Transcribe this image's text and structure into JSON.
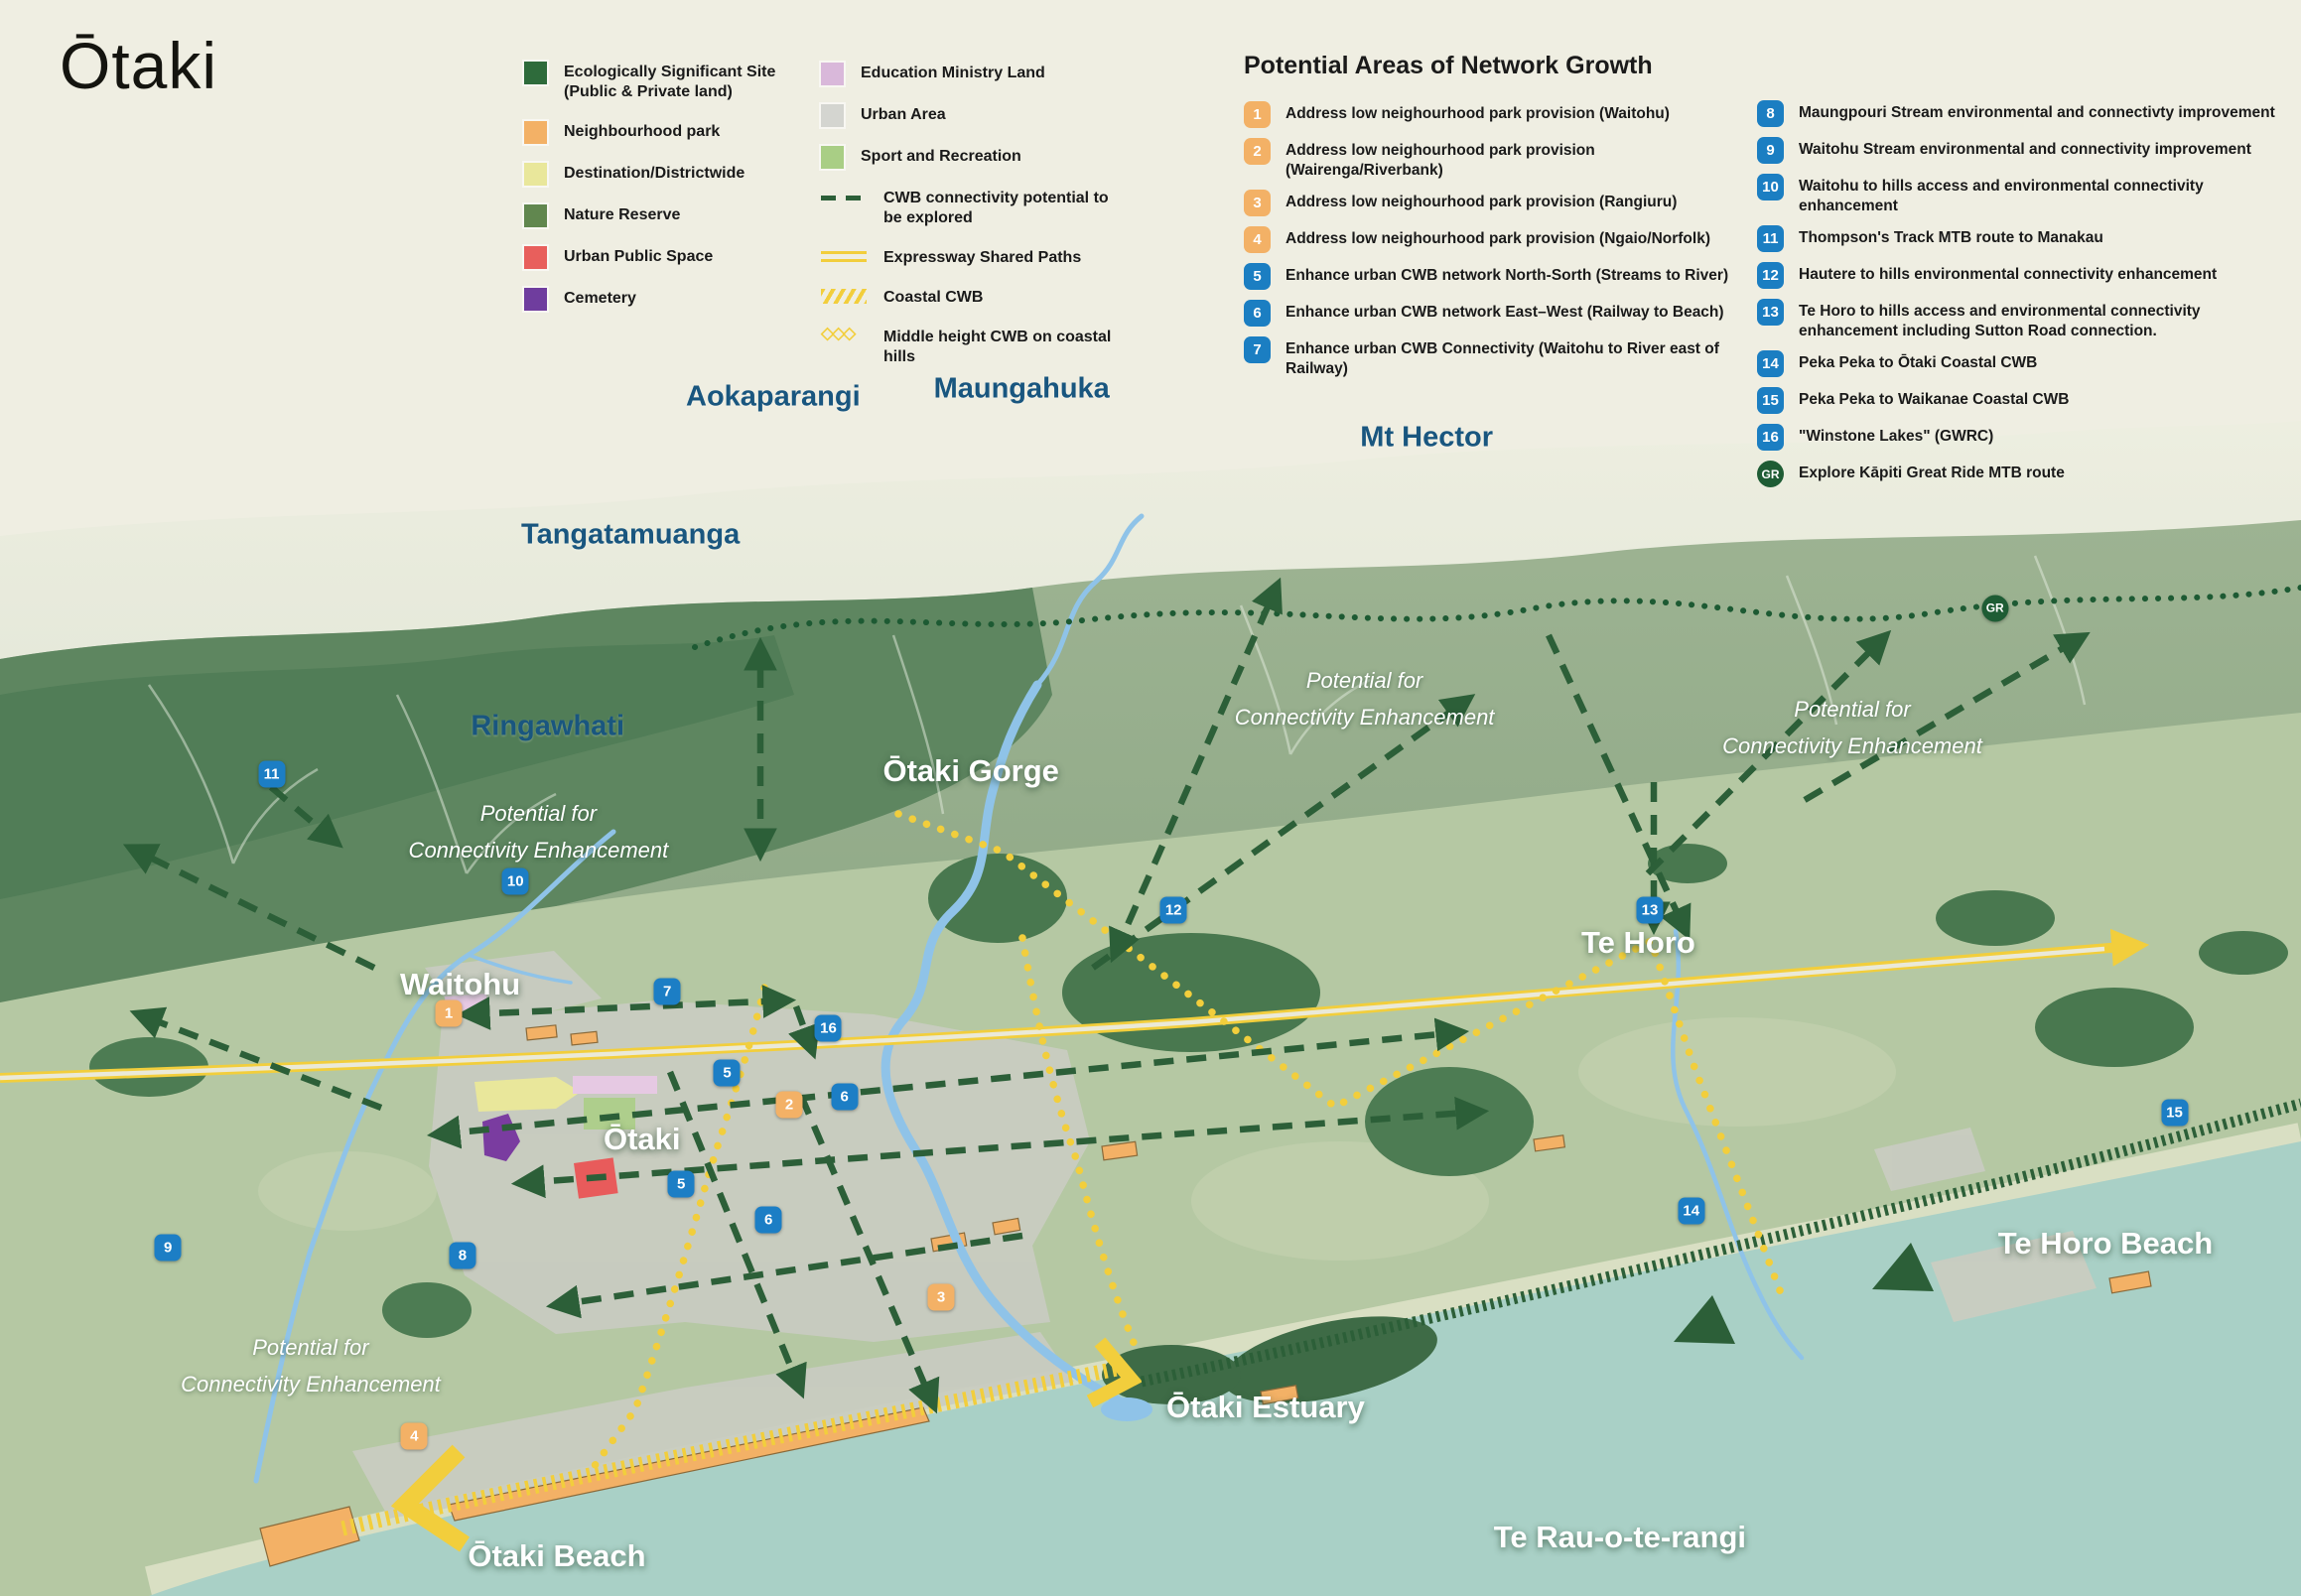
{
  "title": "Ōtaki",
  "legend": {
    "col1": [
      {
        "label": "Ecologically Significant Site (Public & Private land)",
        "kind": "swatch",
        "color": "#2E6B3B"
      },
      {
        "label": "Neighbourhood park",
        "kind": "swatch",
        "color": "#F3B166"
      },
      {
        "label": "Destination/Districtwide",
        "kind": "swatch",
        "color": "#E9E79B"
      },
      {
        "label": "Nature Reserve",
        "kind": "swatch",
        "color": "#61874F"
      },
      {
        "label": "Urban Public Space",
        "kind": "swatch",
        "color": "#E85F5C"
      },
      {
        "label": "Cemetery",
        "kind": "swatch",
        "color": "#6F3D9E"
      }
    ],
    "col2": [
      {
        "label": "Education Ministry Land",
        "kind": "swatch",
        "color": "#D9B8DA"
      },
      {
        "label": "Urban Area",
        "kind": "swatch",
        "color": "#D4D5D0"
      },
      {
        "label": "Sport and Recreation",
        "kind": "swatch",
        "color": "#A9CE85"
      },
      {
        "label": "CWB connectivity potential to be explored",
        "kind": "dashed",
        "color": "#2C5F38"
      },
      {
        "label": "Expressway Shared Paths",
        "kind": "double",
        "color": "#F2CE3C"
      },
      {
        "label": "Coastal CWB",
        "kind": "hatch",
        "color": "#F2CE3C"
      },
      {
        "label": "Middle height CWB on coastal hills",
        "kind": "diamonds",
        "color": "#F2CE3C"
      }
    ]
  },
  "growth": {
    "heading": "Potential Areas of Network Growth",
    "badge_colors": {
      "orange": "#F3B166",
      "blue": "#1B7EC2",
      "green": "#1E5C34"
    },
    "col1": [
      {
        "n": "1",
        "c": "orange",
        "text": "Address low neighourhood park provision (Waitohu)"
      },
      {
        "n": "2",
        "c": "orange",
        "text": "Address low neighourhood park provision (Wairenga/Riverbank)"
      },
      {
        "n": "3",
        "c": "orange",
        "text": "Address low neighourhood park provision (Rangiuru)"
      },
      {
        "n": "4",
        "c": "orange",
        "text": "Address low neighourhood park provision (Ngaio/Norfolk)"
      },
      {
        "n": "5",
        "c": "blue",
        "text": "Enhance urban CWB network North-Sorth (Streams to River)"
      },
      {
        "n": "6",
        "c": "blue",
        "text": "Enhance urban CWB network East–West (Railway to Beach)"
      },
      {
        "n": "7",
        "c": "blue",
        "text": "Enhance urban CWB Connectivity (Waitohu to River east of Railway)"
      }
    ],
    "col2": [
      {
        "n": "8",
        "c": "blue",
        "text": "Maungpouri Stream environmental and connectivty improvement"
      },
      {
        "n": "9",
        "c": "blue",
        "text": "Waitohu Stream environmental and connectivity improvement"
      },
      {
        "n": "10",
        "c": "blue",
        "text": "Waitohu to hills access and environmental connectivity enhancement"
      },
      {
        "n": "11",
        "c": "blue",
        "text": "Thompson's Track MTB route to Manakau"
      },
      {
        "n": "12",
        "c": "blue",
        "text": "Hautere to hills environmental connectivity enhancement"
      },
      {
        "n": "13",
        "c": "blue",
        "text": "Te Horo to hills access and environmental connectivity enhancement including Sutton Road connection."
      },
      {
        "n": "14",
        "c": "blue",
        "text": "Peka Peka to Ōtaki Coastal CWB"
      },
      {
        "n": "15",
        "c": "blue",
        "text": "Peka Peka to Waikanae Coastal CWB"
      },
      {
        "n": "16",
        "c": "blue",
        "text": "\"Winstone Lakes\" (GWRC)"
      },
      {
        "n": "GR",
        "c": "green",
        "text": "Explore Kāpiti Great Ride MTB route"
      }
    ]
  },
  "map": {
    "colors": {
      "background": "#EFEEE2",
      "sea": "#A9D0C6",
      "plain": "#B5C8A3",
      "forest_dark": "#5E8660",
      "eco_patch": "#3E7047",
      "urban": "#C9CCC1",
      "river": "#8FC3E8",
      "route_yellow": "#F2CE3C",
      "route_green": "#2C5F38",
      "label_blue": "#19567F"
    },
    "places": [
      {
        "text": "Aokaparangi",
        "kind": "mountain",
        "x": 33.6,
        "y": 24.9
      },
      {
        "text": "Maungahuka",
        "kind": "mountain",
        "x": 44.4,
        "y": 24.4
      },
      {
        "text": "Mt Hector",
        "kind": "mountain",
        "x": 62.0,
        "y": 27.4
      },
      {
        "text": "Tangatamuanga",
        "kind": "mountain",
        "x": 27.4,
        "y": 33.5
      },
      {
        "text": "Ringawhati",
        "kind": "mountain",
        "x": 23.8,
        "y": 45.5
      },
      {
        "text": "Ōtaki Gorge",
        "kind": "town",
        "x": 42.2,
        "y": 48.3
      },
      {
        "text": "Waitohu",
        "kind": "town",
        "x": 20.0,
        "y": 61.7
      },
      {
        "text": "Ōtaki",
        "kind": "town",
        "x": 27.9,
        "y": 71.4
      },
      {
        "text": "Te Horo",
        "kind": "town",
        "x": 71.2,
        "y": 59.1
      },
      {
        "text": "Te Horo Beach",
        "kind": "town",
        "x": 91.5,
        "y": 77.9
      },
      {
        "text": "Ōtaki Estuary",
        "kind": "town",
        "x": 55.0,
        "y": 88.2
      },
      {
        "text": "Ōtaki Beach",
        "kind": "town",
        "x": 24.2,
        "y": 97.5
      },
      {
        "text": "Te Rau-o-te-rangi",
        "kind": "town",
        "x": 70.4,
        "y": 96.3
      }
    ],
    "annotations": [
      {
        "line1": "Potential for",
        "line2": "Connectivity Enhancement",
        "x": 23.4,
        "y": 52.1
      },
      {
        "line1": "Potential for",
        "line2": "Connectivity Enhancement",
        "x": 59.3,
        "y": 43.8
      },
      {
        "line1": "Potential for",
        "line2": "Connectivity Enhancement",
        "x": 80.5,
        "y": 45.6
      },
      {
        "line1": "Potential for",
        "line2": "Connectivity Enhancement",
        "x": 13.5,
        "y": 85.6
      }
    ],
    "markers": [
      {
        "n": "1",
        "c": "orange",
        "x": 19.5,
        "y": 63.5
      },
      {
        "n": "2",
        "c": "orange",
        "x": 34.3,
        "y": 69.2
      },
      {
        "n": "3",
        "c": "orange",
        "x": 40.9,
        "y": 81.3
      },
      {
        "n": "4",
        "c": "orange",
        "x": 18.0,
        "y": 90.0
      },
      {
        "n": "5",
        "c": "blue",
        "x": 31.6,
        "y": 67.2
      },
      {
        "n": "5",
        "c": "blue",
        "x": 29.6,
        "y": 74.2
      },
      {
        "n": "6",
        "c": "blue",
        "x": 36.7,
        "y": 68.7
      },
      {
        "n": "6",
        "c": "blue",
        "x": 33.4,
        "y": 76.4
      },
      {
        "n": "7",
        "c": "blue",
        "x": 29.0,
        "y": 62.1
      },
      {
        "n": "8",
        "c": "blue",
        "x": 20.1,
        "y": 78.7
      },
      {
        "n": "9",
        "c": "blue",
        "x": 7.3,
        "y": 78.2
      },
      {
        "n": "10",
        "c": "blue",
        "x": 22.4,
        "y": 55.2
      },
      {
        "n": "11",
        "c": "blue",
        "x": 11.8,
        "y": 48.5
      },
      {
        "n": "12",
        "c": "blue",
        "x": 51.0,
        "y": 57.0
      },
      {
        "n": "13",
        "c": "blue",
        "x": 71.7,
        "y": 57.0
      },
      {
        "n": "14",
        "c": "blue",
        "x": 73.5,
        "y": 75.9
      },
      {
        "n": "15",
        "c": "blue",
        "x": 94.5,
        "y": 69.7
      },
      {
        "n": "16",
        "c": "blue",
        "x": 36.0,
        "y": 64.4
      },
      {
        "n": "GR",
        "c": "green",
        "x": 86.7,
        "y": 38.1
      }
    ]
  }
}
